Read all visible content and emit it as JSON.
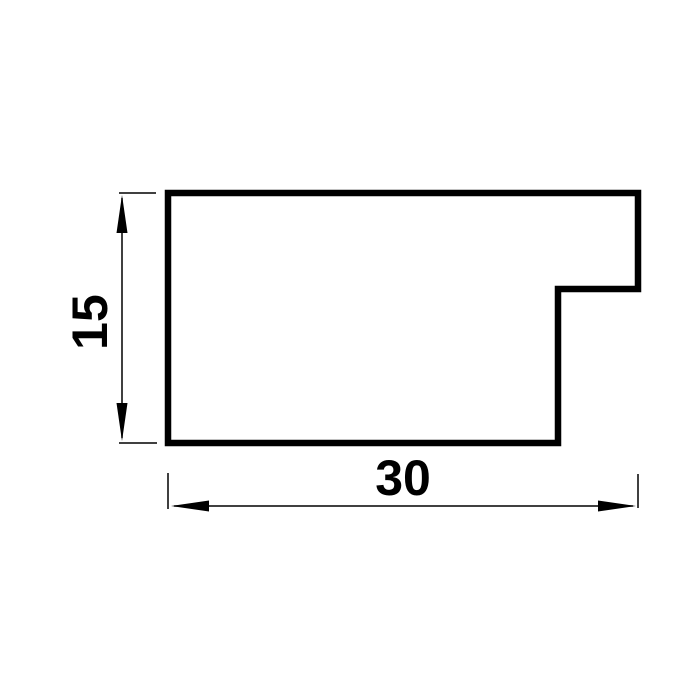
{
  "drawing": {
    "kind": "profile-cross-section-technical-drawing",
    "colors": {
      "line": "#000000",
      "background": "#ffffff"
    },
    "dimensions": {
      "height": {
        "label": "15",
        "value": 15
      },
      "width": {
        "label": "30",
        "value": 30
      }
    }
  }
}
